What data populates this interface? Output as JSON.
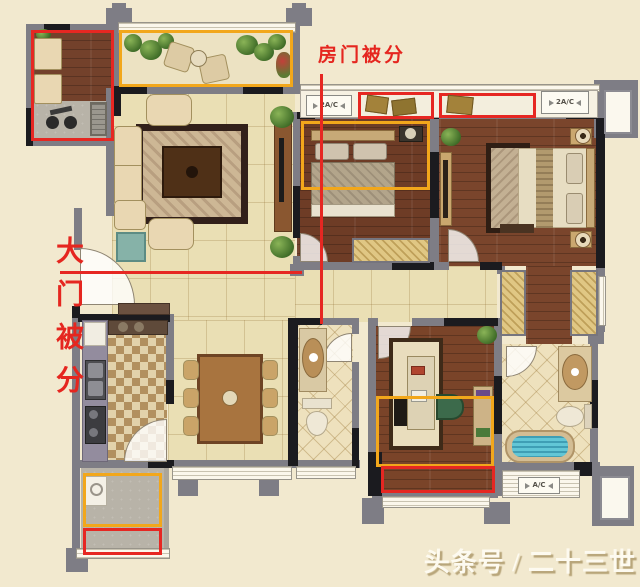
{
  "annotations": {
    "top_label": "房门被分",
    "left_label": "大门被分",
    "line_color": "#e62722"
  },
  "labels": {
    "ac_top_left": "2A/C",
    "ac_top_right": "2A/C",
    "ac_bottom": "A/C"
  },
  "watermark": "头条号 / 二十三世子",
  "palette": {
    "background": "#f2e9cf",
    "wall_gray": "#7e7d85",
    "wall_black": "#1b1b1f",
    "wood_floor": "#74412a",
    "tile_floor": "#eadfb4",
    "diamond_tile": "#eee1bd",
    "annotation_red": "#e62722",
    "highlight_yellow": "#f2a71b",
    "water_blue": "#62c6d6"
  }
}
